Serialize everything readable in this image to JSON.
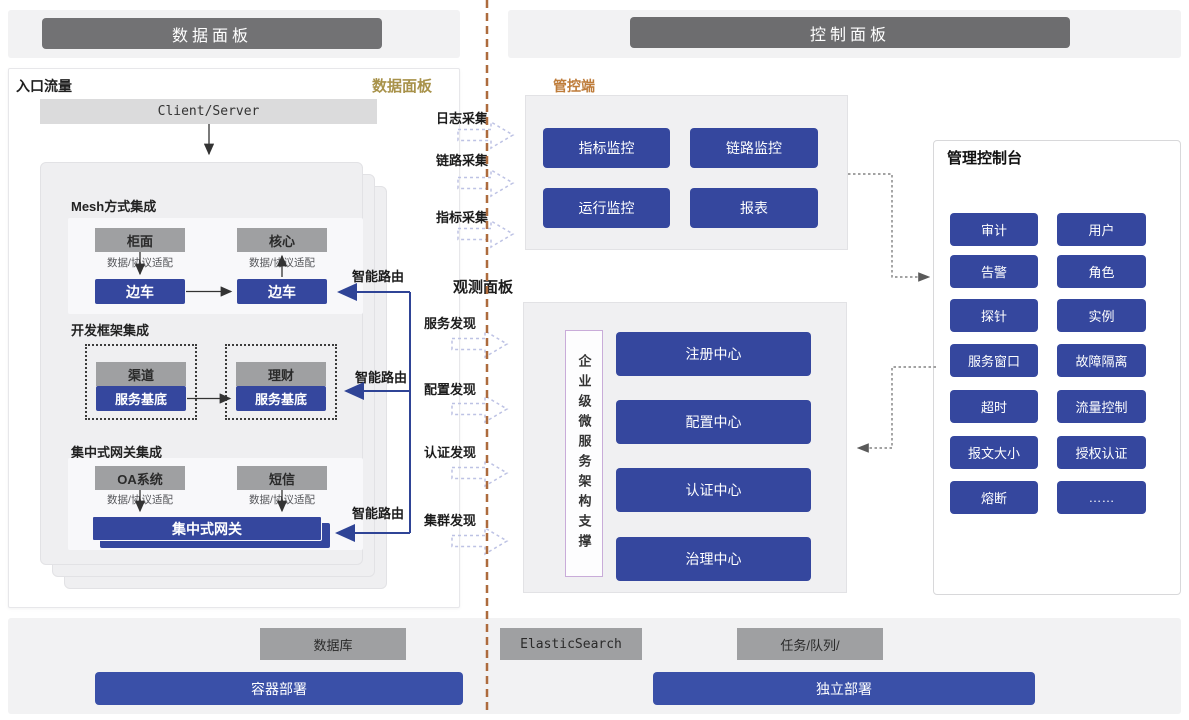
{
  "headers": {
    "left": "数据面板",
    "right": "控制面板"
  },
  "data_panel": {
    "corner_left": "入口流量",
    "corner_right": "数据面板",
    "client_server": "Client/Server",
    "mesh": {
      "title": "Mesh方式集成",
      "left_top": "柜面",
      "right_top": "核心",
      "adapter": "数据/协议适配",
      "left_bottom": "边车",
      "right_bottom": "边车"
    },
    "framework": {
      "title": "开发框架集成",
      "left_top": "渠道",
      "left_bottom": "服务基底",
      "right_top": "理财",
      "right_bottom": "服务基底"
    },
    "gateway": {
      "title": "集中式网关集成",
      "left_top": "OA系统",
      "right_top": "短信",
      "adapter": "数据/协议适配",
      "bus": "集中式网关"
    },
    "smart_route": "智能路由"
  },
  "middle": {
    "collects": [
      "日志采集",
      "链路采集",
      "指标采集"
    ],
    "observe_title": "观测面板",
    "discovers": [
      "服务发现",
      "配置发现",
      "认证发现",
      "集群发现"
    ]
  },
  "control_panel": {
    "manage_label": "管控端",
    "monitors": [
      "指标监控",
      "链路监控",
      "运行监控",
      "报表"
    ],
    "support": "企业级微服务架构支撑",
    "centers": [
      "注册中心",
      "配置中心",
      "认证中心",
      "治理中心"
    ],
    "console_title": "管理控制台",
    "console_buttons": [
      "审计",
      "用户",
      "告警",
      "角色",
      "探针",
      "实例",
      "服务窗口",
      "故障隔离",
      "超时",
      "流量控制",
      "报文大小",
      "授权认证",
      "熔断",
      "……"
    ]
  },
  "footer": {
    "db": "数据库",
    "es": "ElasticSearch",
    "queue": "任务/队列/",
    "container": "容器部署",
    "standalone": "独立部署"
  },
  "colors": {
    "accent_blue": "#35479E",
    "gray_node": "#9FA0A2",
    "header_gray": "#727274",
    "divider_brown": "#AD6B3D",
    "gold_label": "#A8924A",
    "orange_label": "#BE7C3A",
    "dashed_arrow": "#BDC2E4"
  }
}
